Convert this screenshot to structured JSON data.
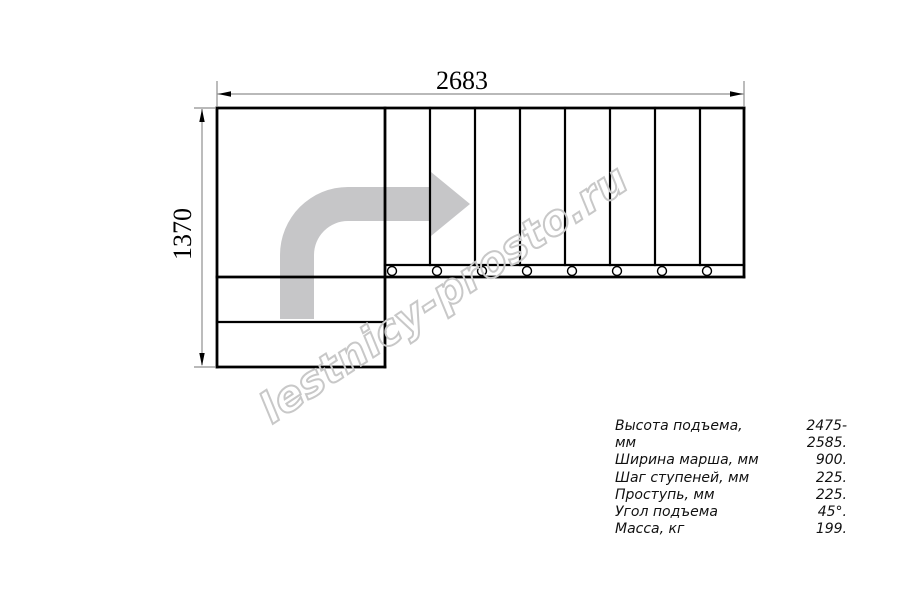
{
  "diagram": {
    "type": "stair-plan-top-view",
    "width_dimension_label": "2683",
    "height_dimension_label": "1370",
    "direction_arrow": "gray-l-shaped-arrow-up-then-right",
    "tread_count_top_flight": 8,
    "lower_step_count": 2,
    "baluster_count": 8
  },
  "watermark": {
    "text": "lestnicy-prosto.ru"
  },
  "specs": {
    "rows": [
      {
        "label": "Высота подъема, мм",
        "value": "2475-2585."
      },
      {
        "label": "Ширина марша, мм",
        "value": "900."
      },
      {
        "label": "Шаг ступеней, мм",
        "value": "225."
      },
      {
        "label": "Проступь, мм",
        "value": "225."
      },
      {
        "label": "Угол подъема",
        "value": "45°."
      },
      {
        "label": "Масса, кг",
        "value": "199."
      }
    ]
  },
  "colors": {
    "drawing_line": "#000000",
    "arrow_fill": "#c6c6c8",
    "watermark_stroke": "#c8c8c8",
    "dimension_line": "#8f8f8f",
    "background": "#ffffff"
  }
}
